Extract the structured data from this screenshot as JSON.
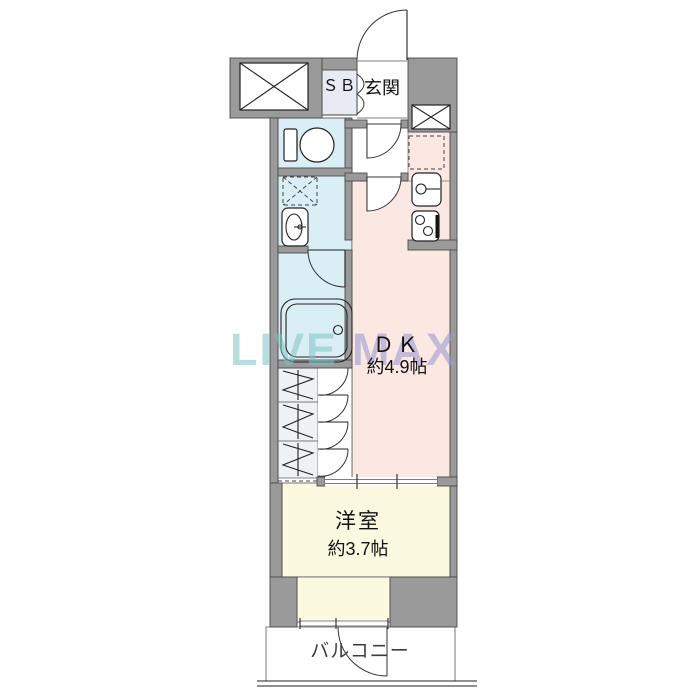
{
  "floorplan": {
    "labels": {
      "shoe_box": "ＳＢ",
      "entrance": "玄関",
      "dining_kitchen": "ＤＫ",
      "dining_kitchen_size": "約4.9帖",
      "western_room": "洋室",
      "western_room_size": "約3.7帖",
      "balcony": "バルコニー"
    },
    "watermark": {
      "left": "LIVE",
      "right": "MAX"
    },
    "colors": {
      "wall": "#9a9a9a",
      "wet-area": "#daeef6",
      "dk-area": "#fbe8e2",
      "room-area": "#fbfae1",
      "sb-box": "#e8ebf4",
      "closet": "#eef1f5",
      "watermark-left": "#7fc3c6",
      "watermark-right": "#9d9dd0"
    }
  }
}
